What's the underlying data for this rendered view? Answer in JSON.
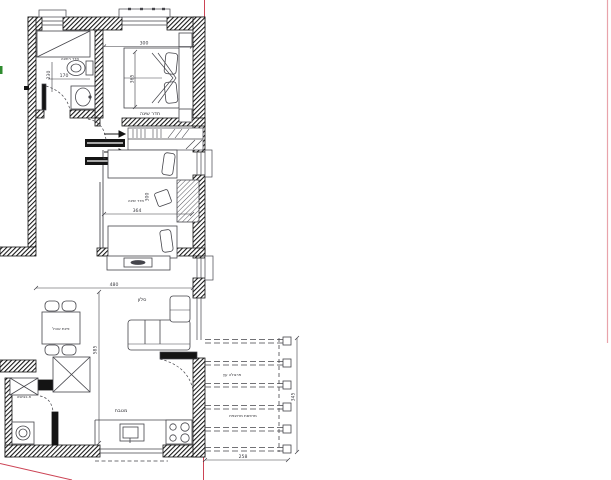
{
  "rooms": {
    "bathroom": "חדר רחצה",
    "bedroom1": "חדר שינה",
    "bedroom2": "חדר שינה",
    "living": "סלון",
    "dining": "פינת אוכל",
    "kitchen": "מטבח",
    "laundry": "ח.כביסה",
    "pergola": "פרגולה עץ",
    "porch": "מרפסת מרוצפת"
  },
  "dims": {
    "bath_w": "170",
    "bath_h": "230",
    "bed1_w": "300",
    "bed1_h": "365",
    "bed2_w": "364",
    "bed2_h": "300",
    "living_w": "480",
    "living_h": "585",
    "porch_h": "345",
    "porch_w": "258"
  },
  "colors": {
    "wall": "#151515",
    "line": "#4a4a50",
    "dim": "#3a3a40",
    "section_red": "#cc4455",
    "section_red_pale": "#e9a3ab",
    "marker_green": "#2e8b2e",
    "background": "#ffffff"
  }
}
